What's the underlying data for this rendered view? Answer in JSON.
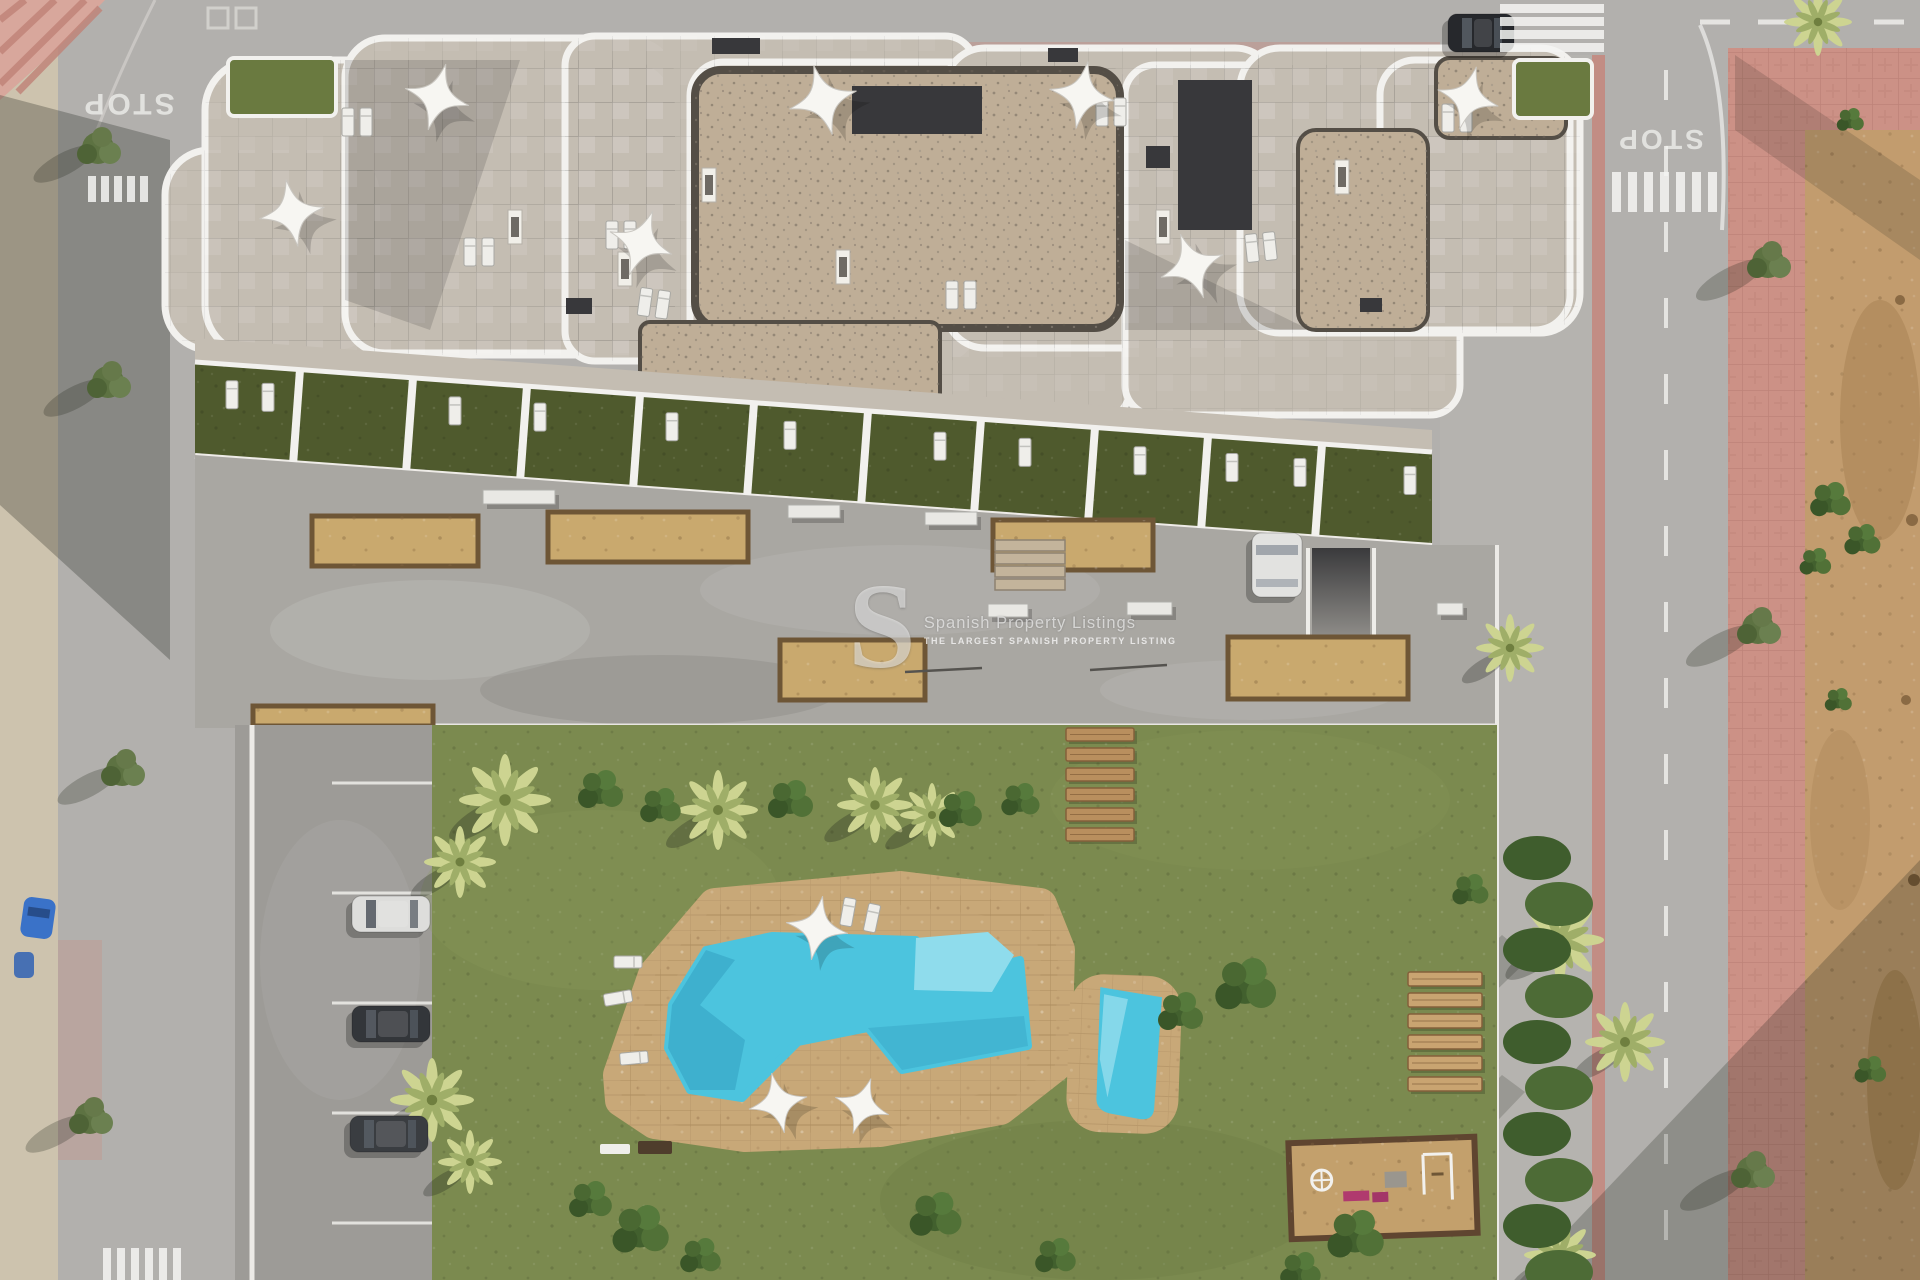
{
  "watermark": {
    "logo": "S",
    "title": "Spanish Property Listings",
    "subtitle": "THE LARGEST SPANISH PROPERTY LISTING"
  },
  "road_markings": {
    "stop": "STOP"
  },
  "palette": {
    "road": "#b2b0ad",
    "roadEdge": "#d8d6d2",
    "sidewalkSand": "#cdc3ae",
    "sand": "#c29c6e",
    "sandDark": "#9c763f",
    "pink": "#cc9186",
    "pinkStripe": "#c4867c",
    "concrete": "#a9a7a2",
    "parking": "#9d9b97",
    "grass": "#7b8a4f",
    "grassDark": "#5d6c38",
    "terraceGarden": "#4f5a2d",
    "hedge": "#42602e",
    "stone": "#c4bdb2",
    "gravel": "#bfae97",
    "gravelEdge": "#544e46",
    "roofDark": "#38383b",
    "green": "#6a7a40",
    "white": "#f2f1ee",
    "deck": "#c8a878",
    "planter": "#c9a96e",
    "planterEdge": "#6e5636",
    "wood": "#b98f5e",
    "woodDark": "#84603a",
    "woodLight": "#c9a471",
    "poolWater": "#4cc4de",
    "poolLight": "#8fdcec",
    "poolDark": "#1d7fa6",
    "carDark": "#26282c",
    "carWhite": "#e3e3e1",
    "carBlue": "#3a72c8",
    "shadow": "#1e2218"
  },
  "scene": {
    "building": {
      "blobs": [
        [
          165,
          150,
          215,
          200,
          45
        ],
        [
          205,
          60,
          470,
          295,
          50
        ],
        [
          345,
          38,
          330,
          315,
          40
        ],
        [
          565,
          36,
          410,
          325,
          30
        ],
        [
          690,
          62,
          440,
          360,
          34
        ],
        [
          945,
          48,
          330,
          300,
          40
        ],
        [
          1125,
          65,
          335,
          350,
          30
        ],
        [
          1240,
          48,
          340,
          285,
          40
        ],
        [
          1380,
          60,
          190,
          270,
          35
        ]
      ],
      "gravel": [
        [
          695,
          70,
          425,
          258,
          26
        ],
        [
          640,
          322,
          300,
          104,
          10
        ],
        [
          1298,
          130,
          130,
          200,
          18
        ],
        [
          1436,
          58,
          130,
          80,
          14
        ]
      ],
      "greens": [
        [
          228,
          58,
          108,
          58
        ],
        [
          1514,
          60,
          78,
          58
        ]
      ],
      "darks": [
        [
          1178,
          80,
          74,
          150
        ],
        [
          852,
          86,
          130,
          48
        ],
        [
          712,
          38,
          48,
          16
        ],
        [
          1146,
          146,
          24,
          22
        ],
        [
          566,
          298,
          26,
          16
        ],
        [
          1048,
          48,
          30,
          14
        ],
        [
          1360,
          298,
          22,
          14
        ]
      ],
      "chimneys": [
        [
          702,
          168
        ],
        [
          618,
          252
        ],
        [
          836,
          250
        ],
        [
          1156,
          210
        ],
        [
          1335,
          160
        ],
        [
          508,
          210
        ]
      ],
      "parasols": [
        [
          437,
          97,
          1.0,
          15
        ],
        [
          292,
          213,
          1.0,
          -10
        ],
        [
          641,
          243,
          1.0,
          20
        ],
        [
          823,
          100,
          1.05,
          -15
        ],
        [
          1082,
          95,
          1.0,
          10
        ],
        [
          1192,
          266,
          1.0,
          -20
        ],
        [
          1468,
          98,
          0.95,
          15
        ]
      ],
      "lounger_pairs": [
        [
          348,
          122,
          0
        ],
        [
          612,
          235,
          0
        ],
        [
          645,
          302,
          8
        ],
        [
          470,
          252,
          0
        ],
        [
          1102,
          112,
          0
        ],
        [
          1252,
          248,
          -6
        ],
        [
          1448,
          118,
          0
        ],
        [
          952,
          295,
          0
        ]
      ],
      "roof_shadows": [
        [
          "345,60 520,60 430,330 345,300",
          0.13
        ],
        [
          "690,330 940,430 700,430",
          0.16
        ],
        [
          "1125,240 1310,330 1125,330",
          0.13
        ]
      ]
    },
    "terraces": {
      "x0": 195,
      "x1": 1432,
      "y_top": 362,
      "slope": 0.0728,
      "height": 93,
      "walls_x": [
        300,
        413,
        527,
        640,
        754,
        868,
        981,
        1095,
        1208,
        1322
      ],
      "lounger_x": [
        232,
        268,
        455,
        540,
        672,
        790,
        940,
        1025,
        1140,
        1232,
        1300,
        1410
      ]
    },
    "driveway": {
      "planters": [
        [
          312,
          516,
          166,
          50
        ],
        [
          548,
          512,
          200,
          50
        ],
        [
          993,
          520,
          160,
          50
        ],
        [
          780,
          640,
          145,
          60
        ],
        [
          1228,
          637,
          180,
          62
        ],
        [
          253,
          706,
          180,
          20
        ]
      ],
      "benches": [
        [
          483,
          490,
          72,
          14
        ],
        [
          788,
          505,
          52,
          13
        ],
        [
          925,
          512,
          52,
          13
        ],
        [
          988,
          604,
          40,
          13
        ],
        [
          1127,
          602,
          45,
          13
        ],
        [
          1437,
          603,
          26,
          12
        ]
      ],
      "rails": [
        [
          905,
          672,
          982,
          668
        ],
        [
          1090,
          670,
          1167,
          665
        ]
      ],
      "steps": {
        "x": 995,
        "y": 540,
        "n": 4,
        "w": 70,
        "h": 11,
        "dy": 13
      }
    },
    "parking": {
      "dividers_y": [
        783,
        893,
        1003,
        1113,
        1223
      ]
    },
    "garden": {
      "wood_steps": {
        "x": 1066,
        "y": 728,
        "n": 6,
        "w": 68,
        "h": 13,
        "dy": 20
      },
      "wood_loungers": {
        "x": 1408,
        "y": 972,
        "n": 6,
        "w": 74,
        "h": 14,
        "dy": 21
      },
      "pool_parasols": [
        [
          817,
          928,
          0.95,
          10
        ],
        [
          778,
          1103,
          0.9,
          -12
        ],
        [
          862,
          1106,
          0.85,
          18
        ]
      ],
      "pool_loungers": [
        [
          628,
          962,
          90
        ],
        [
          618,
          998,
          80
        ],
        [
          634,
          1058,
          85
        ],
        [
          848,
          912,
          10
        ],
        [
          872,
          918,
          12
        ]
      ],
      "palms": [
        [
          505,
          800,
          1.15
        ],
        [
          460,
          862,
          0.9
        ],
        [
          718,
          810,
          1.0
        ],
        [
          875,
          805,
          0.95
        ],
        [
          932,
          815,
          0.8
        ],
        [
          432,
          1100,
          1.05
        ],
        [
          470,
          1162,
          0.8
        ],
        [
          1560,
          940,
          1.1
        ],
        [
          1625,
          1042,
          1.0
        ],
        [
          1560,
          1255,
          0.9
        ],
        [
          1510,
          648,
          0.85
        ]
      ],
      "bushes": [
        [
          600,
          790,
          1.0
        ],
        [
          660,
          806,
          0.9
        ],
        [
          790,
          800,
          1.0
        ],
        [
          960,
          810,
          0.95
        ],
        [
          1020,
          800,
          0.85
        ],
        [
          1245,
          985,
          1.35
        ],
        [
          1180,
          1012,
          1.0
        ],
        [
          640,
          1230,
          1.25
        ],
        [
          590,
          1200,
          0.95
        ],
        [
          700,
          1256,
          0.9
        ],
        [
          935,
          1215,
          1.15
        ],
        [
          1055,
          1256,
          0.9
        ],
        [
          1355,
          1235,
          1.25
        ],
        [
          1300,
          1270,
          0.9
        ],
        [
          1470,
          890,
          0.8
        ]
      ],
      "hedge": {
        "x": 1545,
        "y0": 858,
        "y1": 1275,
        "step": 46
      }
    },
    "trees_left": [
      [
        98,
        148
      ],
      [
        108,
        382
      ],
      [
        122,
        770
      ],
      [
        90,
        1118
      ]
    ],
    "trees_right": [
      [
        1768,
        262
      ],
      [
        1758,
        628
      ],
      [
        1752,
        1172
      ]
    ],
    "sand_shrubs": [
      [
        1830,
        500,
        0.9
      ],
      [
        1862,
        540,
        0.8
      ],
      [
        1815,
        562,
        0.7
      ],
      [
        1850,
        120,
        0.6
      ],
      [
        1838,
        700,
        0.6
      ],
      [
        1870,
        1070,
        0.7
      ]
    ],
    "crosswalks": [
      {
        "x": 88,
        "y": 176,
        "n": 5,
        "dx": 13,
        "w": 8,
        "h": 26
      },
      {
        "x": 103,
        "y": 1248,
        "n": 6,
        "dx": 14,
        "w": 8,
        "h": 32
      },
      {
        "x": 1612,
        "y": 172,
        "n": 7,
        "dx": 16,
        "w": 9,
        "h": 40
      }
    ],
    "top_crosswalk": {
      "x": 1500,
      "ys": [
        4,
        17,
        30,
        43
      ],
      "w": 104,
      "h": 9
    },
    "cars": [
      {
        "x": 352,
        "y": 896,
        "w": 78,
        "h": 36,
        "fill": "#dddddb",
        "dir": "h",
        "name": "parked-car-white"
      },
      {
        "x": 352,
        "y": 1006,
        "w": 78,
        "h": 36,
        "fill": "#33363a",
        "dir": "h",
        "name": "parked-car-dark-1"
      },
      {
        "x": 350,
        "y": 1116,
        "w": 78,
        "h": 36,
        "fill": "#3a3d41",
        "dir": "h",
        "name": "parked-car-dark-2"
      },
      {
        "x": 1448,
        "y": 14,
        "w": 66,
        "h": 38,
        "fill": "#26282c",
        "dir": "h",
        "name": "street-car-dark"
      },
      {
        "x": 1252,
        "y": 533,
        "w": 50,
        "h": 64,
        "fill": "#e2e2e0",
        "dir": "v",
        "name": "driveway-car-white"
      }
    ],
    "shadows": [
      {
        "pts": "0,95 170,140 170,660 0,505",
        "o": 0.28
      },
      {
        "pts": "235,725 432,760 432,1040 235,905",
        "o": 0.2
      },
      {
        "pts": "1502,935 1530,958 1195,1280 1135,1280",
        "o": 0.2
      },
      {
        "pts": "1502,1075 1525,1092 1345,1280 1295,1280",
        "o": 0.18
      },
      {
        "pts": "1060,728 1085,728 945,900 905,888",
        "o": 0.15
      },
      {
        "pts": "1520,1280 1920,860 1920,1280",
        "o": 0.24
      },
      {
        "pts": "1735,55 1920,180 1920,260 1735,130",
        "o": 0.16
      }
    ]
  }
}
